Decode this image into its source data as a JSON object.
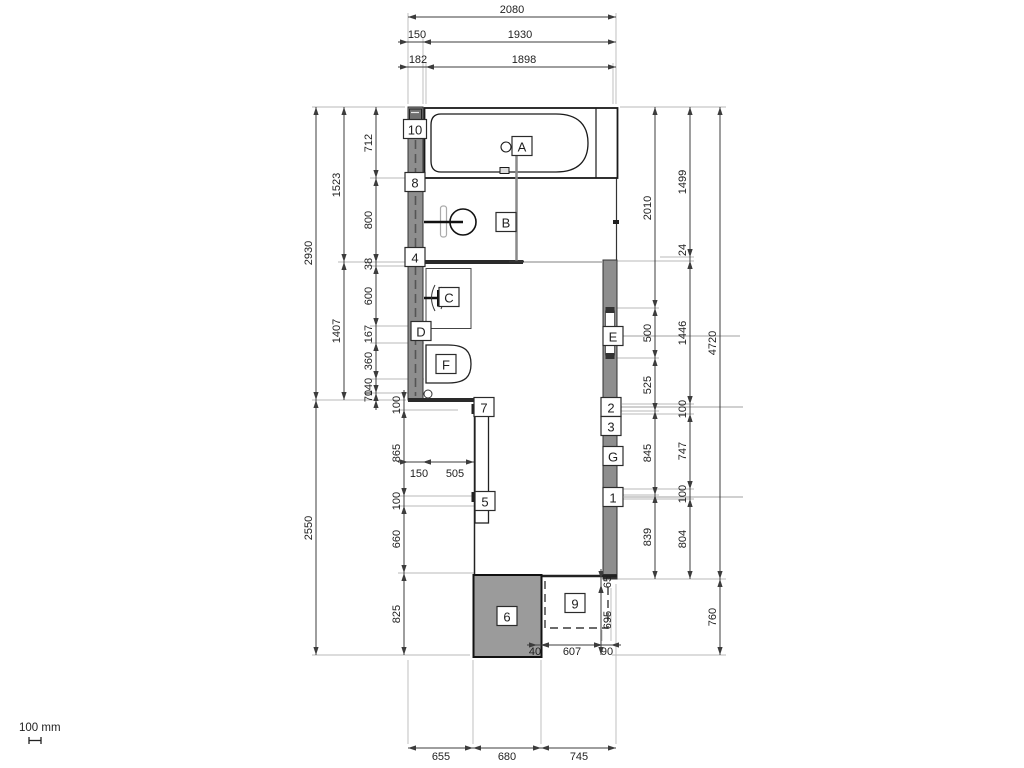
{
  "scale_indicator": {
    "label": "100 mm"
  },
  "colors": {
    "wall_fill": "#8e8e8e",
    "tray_fill": "#9b9b9b",
    "line_dark": "#1a1a1a",
    "dim_line": "#3c3c3c",
    "ext_line": "#b9b9b9",
    "leader_line": "#a0a0a0",
    "callout_border": "#2b2b2b"
  },
  "callouts": [
    {
      "id": "A",
      "x": 522,
      "y": 146
    },
    {
      "id": "B",
      "x": 506,
      "y": 222
    },
    {
      "id": "C",
      "x": 449,
      "y": 297
    },
    {
      "id": "D",
      "x": 421,
      "y": 331
    },
    {
      "id": "E",
      "x": 613,
      "y": 336
    },
    {
      "id": "F",
      "x": 446,
      "y": 364
    },
    {
      "id": "G",
      "x": 613,
      "y": 456
    },
    {
      "id": "1",
      "x": 613,
      "y": 497
    },
    {
      "id": "2",
      "x": 611,
      "y": 407
    },
    {
      "id": "3",
      "x": 611,
      "y": 426
    },
    {
      "id": "4",
      "x": 415,
      "y": 257
    },
    {
      "id": "5",
      "x": 485,
      "y": 501
    },
    {
      "id": "6",
      "x": 507,
      "y": 616
    },
    {
      "id": "7",
      "x": 484,
      "y": 407
    },
    {
      "id": "8",
      "x": 415,
      "y": 182
    },
    {
      "id": "9",
      "x": 575,
      "y": 603
    },
    {
      "id": "10",
      "x": 415,
      "y": 129
    }
  ],
  "dims": [
    {
      "v": "2080",
      "o": "h",
      "a": 408,
      "b": 616,
      "p": 17,
      "lx": 512,
      "ly": 10,
      "s": "in"
    },
    {
      "v": "150",
      "o": "h",
      "a": 408,
      "b": 423,
      "p": 42,
      "lx": 417,
      "ly": 35,
      "s": "out"
    },
    {
      "v": "1930",
      "o": "h",
      "a": 423,
      "b": 616,
      "p": 42,
      "lx": 520,
      "ly": 35,
      "s": "in"
    },
    {
      "v": "182",
      "o": "h",
      "a": 408,
      "b": 426,
      "p": 67,
      "lx": 418,
      "ly": 60,
      "s": "out"
    },
    {
      "v": "1898",
      "o": "h",
      "a": 426,
      "b": 616,
      "p": 67,
      "lx": 524,
      "ly": 60,
      "s": "in"
    },
    {
      "v": "2930",
      "o": "v",
      "a": 107,
      "b": 400,
      "p": 316,
      "lx": 309,
      "ly": 253,
      "s": "in"
    },
    {
      "v": "2550",
      "o": "v",
      "a": 400,
      "b": 655,
      "p": 316,
      "lx": 309,
      "ly": 528,
      "s": "in"
    },
    {
      "v": "1523",
      "o": "v",
      "a": 107,
      "b": 262,
      "p": 344,
      "lx": 337,
      "ly": 185,
      "s": "in"
    },
    {
      "v": "1407",
      "o": "v",
      "a": 262,
      "b": 400,
      "p": 344,
      "lx": 337,
      "ly": 331,
      "s": "in"
    },
    {
      "v": "712",
      "o": "v",
      "a": 107,
      "b": 178,
      "p": 376,
      "lx": 369,
      "ly": 143,
      "s": "in"
    },
    {
      "v": "800",
      "o": "v",
      "a": 178,
      "b": 262,
      "p": 376,
      "lx": 369,
      "ly": 220,
      "s": "in"
    },
    {
      "v": "38",
      "o": "v",
      "a": 262,
      "b": 266,
      "p": 376,
      "lx": 369,
      "ly": 264,
      "s": "out"
    },
    {
      "v": "600",
      "o": "v",
      "a": 266,
      "b": 326,
      "p": 376,
      "lx": 369,
      "ly": 296,
      "s": "in"
    },
    {
      "v": "167",
      "o": "v",
      "a": 326,
      "b": 343,
      "p": 376,
      "lx": 369,
      "ly": 334,
      "s": "out"
    },
    {
      "v": "360",
      "o": "v",
      "a": 343,
      "b": 379,
      "p": 376,
      "lx": 369,
      "ly": 361,
      "s": "in"
    },
    {
      "v": "140",
      "o": "v",
      "a": 379,
      "b": 393,
      "p": 376,
      "lx": 369,
      "ly": 387,
      "s": "out"
    },
    {
      "v": "70",
      "o": "v",
      "a": 393,
      "b": 400,
      "p": 376,
      "lx": 369,
      "ly": 396,
      "s": "out"
    },
    {
      "v": "100",
      "o": "v",
      "a": 400,
      "b": 410,
      "p": 404,
      "lx": 397,
      "ly": 405,
      "s": "out"
    },
    {
      "v": "865",
      "o": "v",
      "a": 410,
      "b": 496,
      "p": 404,
      "lx": 397,
      "ly": 453,
      "s": "in"
    },
    {
      "v": "100",
      "o": "v",
      "a": 496,
      "b": 506,
      "p": 404,
      "lx": 397,
      "ly": 501,
      "s": "out"
    },
    {
      "v": "660",
      "o": "v",
      "a": 506,
      "b": 573,
      "p": 404,
      "lx": 397,
      "ly": 539,
      "s": "in"
    },
    {
      "v": "825",
      "o": "v",
      "a": 573,
      "b": 655,
      "p": 404,
      "lx": 397,
      "ly": 614,
      "s": "in"
    },
    {
      "v": "150",
      "o": "h",
      "a": 408,
      "b": 423,
      "p": 462,
      "lx": 419,
      "ly": 474,
      "s": "out"
    },
    {
      "v": "505",
      "o": "h",
      "a": 423,
      "b": 474,
      "p": 462,
      "lx": 455,
      "ly": 474,
      "s": "in"
    },
    {
      "v": "2010",
      "o": "v",
      "a": 107,
      "b": 308,
      "p": 655,
      "lx": 648,
      "ly": 208,
      "s": "in"
    },
    {
      "v": "500",
      "o": "v",
      "a": 308,
      "b": 358,
      "p": 655,
      "lx": 648,
      "ly": 333,
      "s": "in"
    },
    {
      "v": "525",
      "o": "v",
      "a": 358,
      "b": 411,
      "p": 655,
      "lx": 648,
      "ly": 385,
      "s": "in"
    },
    {
      "v": "845",
      "o": "v",
      "a": 411,
      "b": 495,
      "p": 655,
      "lx": 648,
      "ly": 453,
      "s": "in"
    },
    {
      "v": "839",
      "o": "v",
      "a": 495,
      "b": 579,
      "p": 655,
      "lx": 648,
      "ly": 537,
      "s": "in"
    },
    {
      "v": "1499",
      "o": "v",
      "a": 107,
      "b": 257,
      "p": 690,
      "lx": 683,
      "ly": 182,
      "s": "in"
    },
    {
      "v": "24",
      "o": "v",
      "a": 257,
      "b": 261,
      "p": 690,
      "lx": 683,
      "ly": 250,
      "s": "out"
    },
    {
      "v": "1446",
      "o": "v",
      "a": 261,
      "b": 404,
      "p": 690,
      "lx": 683,
      "ly": 333,
      "s": "in"
    },
    {
      "v": "100",
      "o": "v",
      "a": 404,
      "b": 414,
      "p": 690,
      "lx": 683,
      "ly": 409,
      "s": "out"
    },
    {
      "v": "747",
      "o": "v",
      "a": 414,
      "b": 489,
      "p": 690,
      "lx": 683,
      "ly": 451,
      "s": "in"
    },
    {
      "v": "100",
      "o": "v",
      "a": 489,
      "b": 499,
      "p": 690,
      "lx": 683,
      "ly": 494,
      "s": "out"
    },
    {
      "v": "804",
      "o": "v",
      "a": 499,
      "b": 579,
      "p": 690,
      "lx": 683,
      "ly": 539,
      "s": "in"
    },
    {
      "v": "4720",
      "o": "v",
      "a": 107,
      "b": 579,
      "p": 720,
      "lx": 713,
      "ly": 343,
      "s": "in"
    },
    {
      "v": "760",
      "o": "v",
      "a": 579,
      "b": 655,
      "p": 720,
      "lx": 713,
      "ly": 617,
      "s": "in"
    },
    {
      "v": "655",
      "o": "h",
      "a": 408,
      "b": 473,
      "p": 748,
      "lx": 441,
      "ly": 757,
      "s": "in"
    },
    {
      "v": "680",
      "o": "h",
      "a": 473,
      "b": 541,
      "p": 748,
      "lx": 507,
      "ly": 757,
      "s": "in"
    },
    {
      "v": "745",
      "o": "h",
      "a": 541,
      "b": 616,
      "p": 748,
      "lx": 579,
      "ly": 757,
      "s": "in"
    },
    {
      "v": "40",
      "o": "h",
      "a": 537,
      "b": 541,
      "p": 645,
      "lx": 535,
      "ly": 652,
      "s": "out"
    },
    {
      "v": "607",
      "o": "h",
      "a": 541,
      "b": 602,
      "p": 645,
      "lx": 572,
      "ly": 652,
      "s": "in"
    },
    {
      "v": "90",
      "o": "h",
      "a": 602,
      "b": 611,
      "p": 645,
      "lx": 607,
      "ly": 652,
      "s": "out"
    },
    {
      "v": "65",
      "o": "v",
      "a": 579,
      "b": 585,
      "p": 601,
      "lx": 608,
      "ly": 582,
      "s": "out"
    },
    {
      "v": "695",
      "o": "v",
      "a": 585,
      "b": 655,
      "p": 601,
      "lx": 608,
      "ly": 620,
      "s": "in"
    }
  ]
}
